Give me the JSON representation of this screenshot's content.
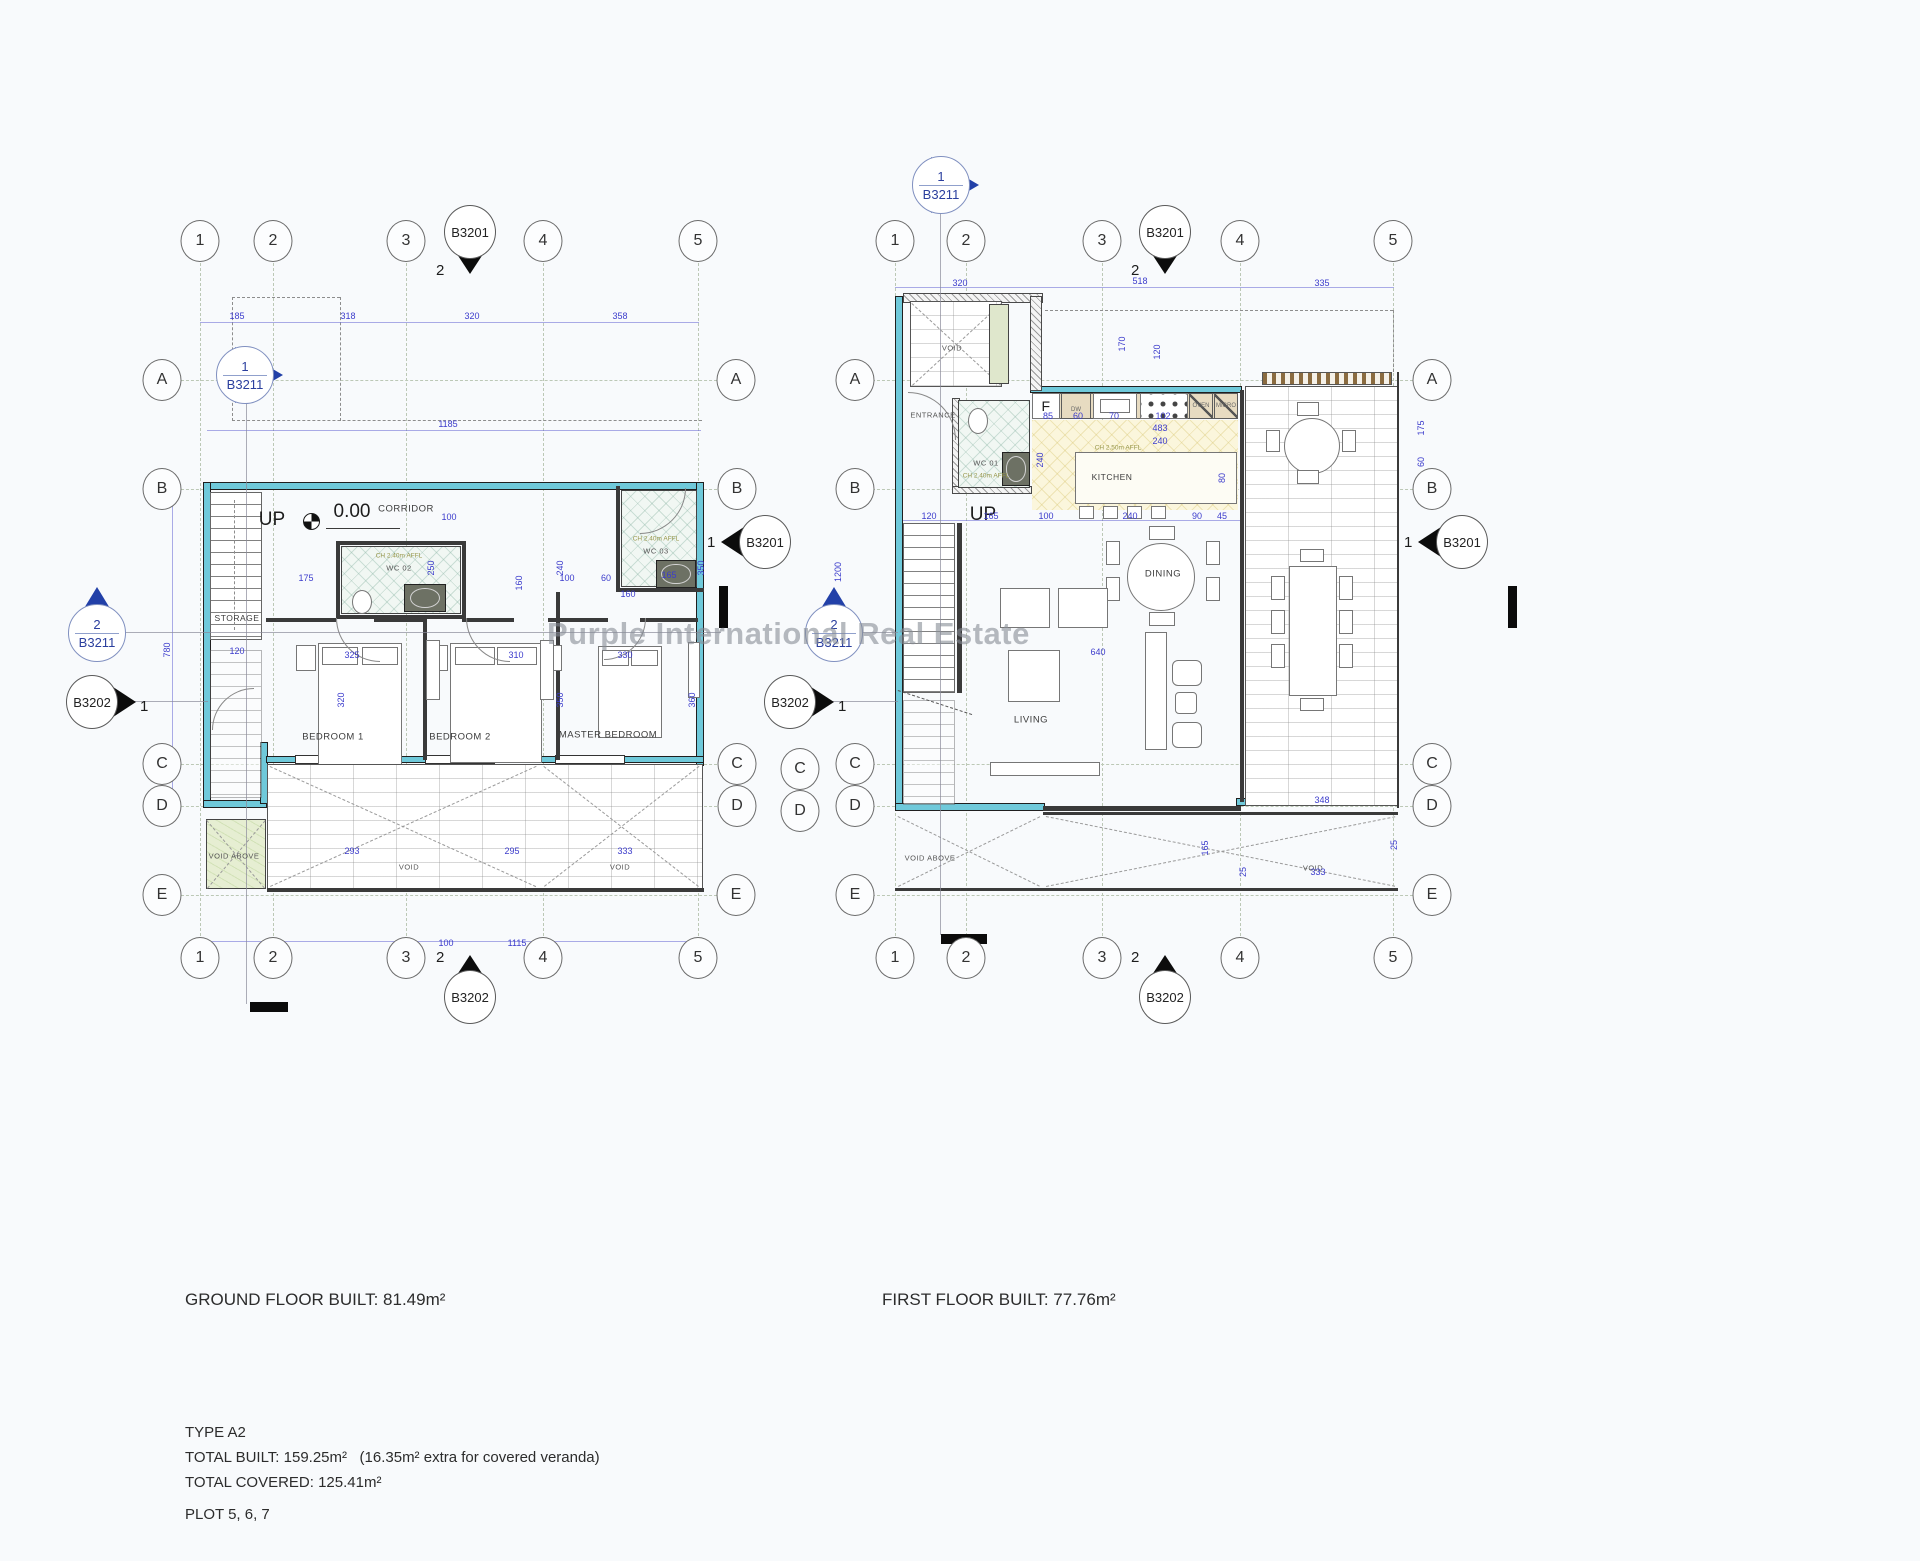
{
  "watermark": "Purple International Real Estate",
  "captions": {
    "ground": "GROUND FLOOR BUILT: 81.49m²",
    "first": "FIRST FLOOR BUILT: 77.76m²"
  },
  "summary": {
    "type": "TYPE A2",
    "built": "TOTAL BUILT: 159.25m²",
    "built_note": "(16.35m² extra for covered veranda)",
    "covered": "TOTAL COVERED: 125.41m²",
    "plot": "PLOT 5, 6, 7"
  },
  "sections": {
    "b3201": "B3201",
    "b3211": "B3211",
    "b3202": "B3202",
    "n1": "1",
    "n2": "2"
  },
  "ground": {
    "bubbles": [
      {
        "t": "1",
        "x": 200,
        "y": 241
      },
      {
        "t": "2",
        "x": 273,
        "y": 241
      },
      {
        "t": "3",
        "x": 406,
        "y": 241
      },
      {
        "t": "4",
        "x": 543,
        "y": 241
      },
      {
        "t": "5",
        "x": 698,
        "y": 241
      },
      {
        "t": "1",
        "x": 200,
        "y": 958
      },
      {
        "t": "2",
        "x": 273,
        "y": 958
      },
      {
        "t": "3",
        "x": 406,
        "y": 958
      },
      {
        "t": "4",
        "x": 543,
        "y": 958
      },
      {
        "t": "5",
        "x": 698,
        "y": 958
      },
      {
        "t": "A",
        "x": 162,
        "y": 380
      },
      {
        "t": "B",
        "x": 162,
        "y": 489
      },
      {
        "t": "C",
        "x": 162,
        "y": 764
      },
      {
        "t": "D",
        "x": 162,
        "y": 806
      },
      {
        "t": "E",
        "x": 162,
        "y": 895
      },
      {
        "t": "A",
        "x": 736,
        "y": 380
      },
      {
        "t": "B",
        "x": 737,
        "y": 489
      },
      {
        "t": "C",
        "x": 737,
        "y": 764
      },
      {
        "t": "D",
        "x": 737,
        "y": 806
      },
      {
        "t": "E",
        "x": 736,
        "y": 895
      }
    ],
    "rooms": [
      {
        "t": "UP",
        "x": 272,
        "y": 520,
        "cls": "room-lg"
      },
      {
        "t": "0.00",
        "x": 352,
        "y": 512,
        "cls": "room-lg"
      },
      {
        "t": "CORRIDOR",
        "x": 406,
        "y": 509
      },
      {
        "t": "STORAGE",
        "x": 237,
        "y": 618,
        "cls": "room-sm"
      },
      {
        "t": "CH 2.40m AFFL",
        "x": 399,
        "y": 556,
        "cls": "room-note"
      },
      {
        "t": "WC 02",
        "x": 399,
        "y": 568,
        "cls": "room-xs"
      },
      {
        "t": "CH 2.40m AFFL",
        "x": 656,
        "y": 539,
        "cls": "room-note"
      },
      {
        "t": "WC 03",
        "x": 656,
        "y": 551,
        "cls": "room-xs"
      },
      {
        "t": "BEDROOM 1",
        "x": 333,
        "y": 737
      },
      {
        "t": "BEDROOM 2",
        "x": 460,
        "y": 737
      },
      {
        "t": "MASTER BEDROOM",
        "x": 608,
        "y": 735
      },
      {
        "t": "VOID ABOVE",
        "x": 234,
        "y": 856,
        "cls": "room-xs"
      },
      {
        "t": "VOID",
        "x": 409,
        "y": 867,
        "cls": "room-xs"
      },
      {
        "t": "VOID",
        "x": 620,
        "y": 867,
        "cls": "room-xs"
      }
    ],
    "dims": [
      {
        "t": "185",
        "x": 237,
        "y": 316
      },
      {
        "t": "318",
        "x": 348,
        "y": 316
      },
      {
        "t": "320",
        "x": 472,
        "y": 316
      },
      {
        "t": "358",
        "x": 620,
        "y": 316
      },
      {
        "t": "1185",
        "x": 448,
        "y": 424
      },
      {
        "t": "780",
        "x": 167,
        "y": 650,
        "r": 1
      },
      {
        "t": "120",
        "x": 237,
        "y": 651
      },
      {
        "t": "175",
        "x": 306,
        "y": 578
      },
      {
        "t": "100",
        "x": 449,
        "y": 517
      },
      {
        "t": "250",
        "x": 431,
        "y": 568,
        "r": 1
      },
      {
        "t": "240",
        "x": 560,
        "y": 568,
        "r": 1
      },
      {
        "t": "160",
        "x": 519,
        "y": 583,
        "r": 1
      },
      {
        "t": "100",
        "x": 567,
        "y": 578
      },
      {
        "t": "60",
        "x": 606,
        "y": 578
      },
      {
        "t": "165",
        "x": 669,
        "y": 575
      },
      {
        "t": "350",
        "x": 701,
        "y": 568,
        "r": 1
      },
      {
        "t": "160",
        "x": 628,
        "y": 594
      },
      {
        "t": "325",
        "x": 352,
        "y": 655
      },
      {
        "t": "310",
        "x": 516,
        "y": 655
      },
      {
        "t": "330",
        "x": 625,
        "y": 655
      },
      {
        "t": "320",
        "x": 341,
        "y": 700,
        "r": 1
      },
      {
        "t": "350",
        "x": 560,
        "y": 700,
        "r": 1
      },
      {
        "t": "360",
        "x": 692,
        "y": 700,
        "r": 1
      },
      {
        "t": "100",
        "x": 446,
        "y": 943
      },
      {
        "t": "1115",
        "x": 517,
        "y": 943
      },
      {
        "t": "293",
        "x": 352,
        "y": 851
      },
      {
        "t": "295",
        "x": 512,
        "y": 851
      },
      {
        "t": "333",
        "x": 625,
        "y": 851
      }
    ]
  },
  "first": {
    "bubbles": [
      {
        "t": "1",
        "x": 895,
        "y": 241
      },
      {
        "t": "2",
        "x": 966,
        "y": 241
      },
      {
        "t": "3",
        "x": 1102,
        "y": 241
      },
      {
        "t": "4",
        "x": 1240,
        "y": 241
      },
      {
        "t": "5",
        "x": 1393,
        "y": 241
      },
      {
        "t": "1",
        "x": 895,
        "y": 958
      },
      {
        "t": "2",
        "x": 966,
        "y": 958
      },
      {
        "t": "3",
        "x": 1102,
        "y": 958
      },
      {
        "t": "4",
        "x": 1240,
        "y": 958
      },
      {
        "t": "5",
        "x": 1393,
        "y": 958
      },
      {
        "t": "A",
        "x": 855,
        "y": 380
      },
      {
        "t": "B",
        "x": 855,
        "y": 489
      },
      {
        "t": "C",
        "x": 855,
        "y": 764
      },
      {
        "t": "D",
        "x": 855,
        "y": 806
      },
      {
        "t": "E",
        "x": 855,
        "y": 895
      },
      {
        "t": "C",
        "x": 800,
        "y": 769
      },
      {
        "t": "D",
        "x": 800,
        "y": 811
      },
      {
        "t": "A",
        "x": 1432,
        "y": 380
      },
      {
        "t": "B",
        "x": 1432,
        "y": 489
      },
      {
        "t": "C",
        "x": 1432,
        "y": 764
      },
      {
        "t": "D",
        "x": 1432,
        "y": 806
      },
      {
        "t": "E",
        "x": 1432,
        "y": 895
      }
    ],
    "rooms": [
      {
        "t": "VOID",
        "x": 952,
        "y": 348,
        "cls": "room-xs"
      },
      {
        "t": "ENTRANCE",
        "x": 933,
        "y": 415,
        "cls": "room-xs"
      },
      {
        "t": "WC 01",
        "x": 986,
        "y": 463,
        "cls": "room-xs"
      },
      {
        "t": "CH 2.40m AFFL",
        "x": 986,
        "y": 476,
        "cls": "room-note"
      },
      {
        "t": "F",
        "x": 1046,
        "y": 406,
        "cls": "room-md"
      },
      {
        "t": "DW",
        "x": 1076,
        "y": 410,
        "cls": "room-tiny"
      },
      {
        "t": "OVEN",
        "x": 1201,
        "y": 406,
        "cls": "room-tiny"
      },
      {
        "t": "MICRO",
        "x": 1226,
        "y": 406,
        "cls": "room-tiny"
      },
      {
        "t": "CH 2.50m AFFL",
        "x": 1118,
        "y": 448,
        "cls": "room-note"
      },
      {
        "t": "KITCHEN",
        "x": 1112,
        "y": 477,
        "cls": "room-sm"
      },
      {
        "t": "UP",
        "x": 983,
        "y": 515,
        "cls": "room-lg"
      },
      {
        "t": "DINING",
        "x": 1163,
        "y": 574
      },
      {
        "t": "LIVING",
        "x": 1031,
        "y": 720
      },
      {
        "t": "VOID ABOVE",
        "x": 930,
        "y": 858,
        "cls": "room-xs"
      },
      {
        "t": "VOID",
        "x": 1313,
        "y": 868,
        "cls": "room-xs"
      }
    ],
    "dims": [
      {
        "t": "320",
        "x": 960,
        "y": 283
      },
      {
        "t": "518",
        "x": 1140,
        "y": 281
      },
      {
        "t": "335",
        "x": 1322,
        "y": 283
      },
      {
        "t": "170",
        "x": 1122,
        "y": 344,
        "r": 1
      },
      {
        "t": "120",
        "x": 1157,
        "y": 352,
        "r": 1
      },
      {
        "t": "85",
        "x": 1048,
        "y": 416
      },
      {
        "t": "60",
        "x": 1078,
        "y": 416
      },
      {
        "t": "70",
        "x": 1114,
        "y": 416
      },
      {
        "t": "102",
        "x": 1163,
        "y": 416
      },
      {
        "t": "483",
        "x": 1160,
        "y": 428
      },
      {
        "t": "240",
        "x": 1160,
        "y": 441
      },
      {
        "t": "240",
        "x": 1040,
        "y": 460,
        "r": 1
      },
      {
        "t": "80",
        "x": 1222,
        "y": 478,
        "r": 1
      },
      {
        "t": "120",
        "x": 929,
        "y": 516
      },
      {
        "t": "165",
        "x": 991,
        "y": 516
      },
      {
        "t": "100",
        "x": 1046,
        "y": 516
      },
      {
        "t": "240",
        "x": 1130,
        "y": 516
      },
      {
        "t": "90",
        "x": 1197,
        "y": 516
      },
      {
        "t": "45",
        "x": 1222,
        "y": 516
      },
      {
        "t": "1200",
        "x": 838,
        "y": 572,
        "r": 1
      },
      {
        "t": "640",
        "x": 1098,
        "y": 652
      },
      {
        "t": "175",
        "x": 1421,
        "y": 428,
        "r": 1
      },
      {
        "t": "60",
        "x": 1421,
        "y": 462,
        "r": 1
      },
      {
        "t": "348",
        "x": 1322,
        "y": 800
      },
      {
        "t": "165",
        "x": 1205,
        "y": 848,
        "r": 1
      },
      {
        "t": "333",
        "x": 1318,
        "y": 872
      },
      {
        "t": "25",
        "x": 1243,
        "y": 872,
        "r": 1
      },
      {
        "t": "25",
        "x": 1394,
        "y": 845,
        "r": 1
      }
    ]
  }
}
